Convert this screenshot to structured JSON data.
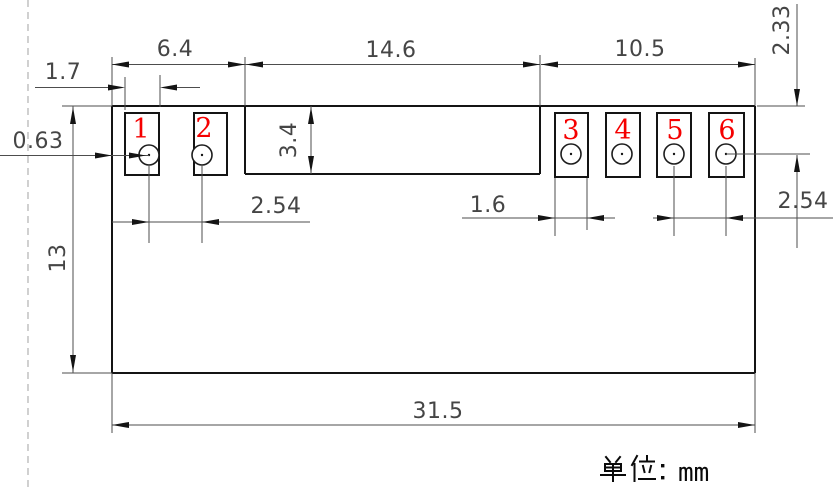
{
  "drawing": {
    "type": "mechanical-dimension-drawing",
    "unit_note": {
      "text": "单位：mm",
      "cjk": "单位",
      "unit": "mm"
    },
    "pin_numbers": [
      "1",
      "2",
      "3",
      "4",
      "5",
      "6"
    ],
    "dimensions": {
      "left_section_width": "6.4",
      "middle_section_width": "14.6",
      "right_section_width": "10.5",
      "left_pad_width": "1.7",
      "left_edge_gap": "0.63",
      "notch_depth": "3.4",
      "left_pin_pitch": "2.54",
      "right_pad_width": "1.6",
      "right_pin_pitch": "2.54",
      "top_to_hole_center": "2.33",
      "body_height": "13",
      "body_width": "31.5"
    },
    "colors": {
      "pin_number": "#f50000",
      "outline": "#141414",
      "dimension_line": "#4d4d4d",
      "dimension_text": "#454545",
      "background": "#ffffff"
    }
  }
}
